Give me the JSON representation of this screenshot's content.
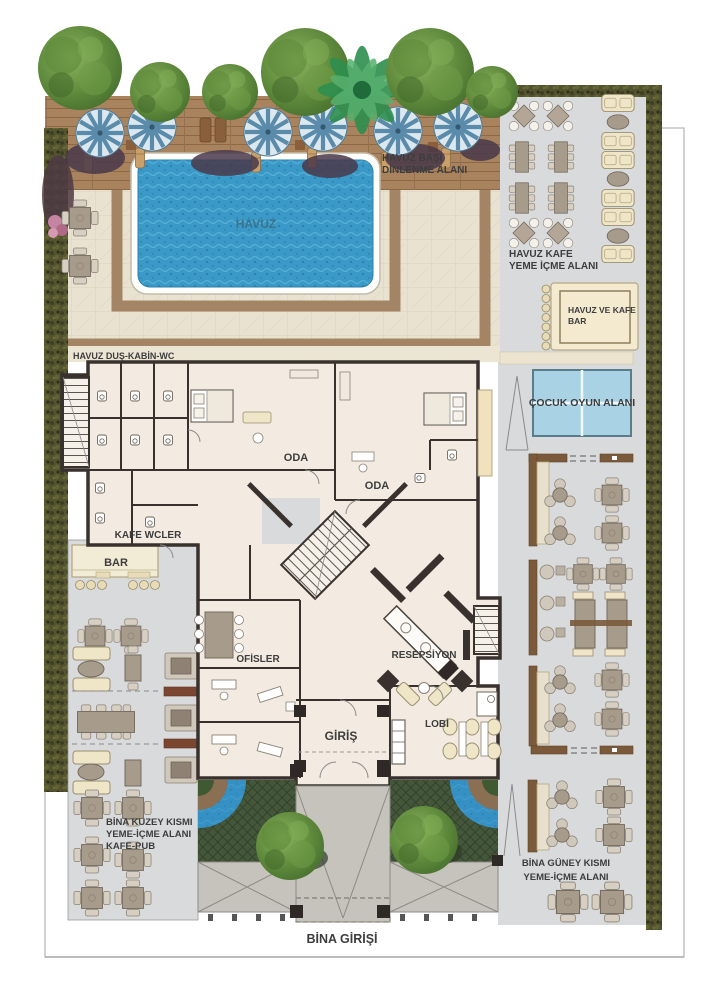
{
  "labels": {
    "pool": "HAVUZ",
    "pool_rest": {
      "l1": "HAVUZ BAŞI",
      "l2": "DİNLENME ALANI"
    },
    "pool_cafe": {
      "l1": "HAVUZ KAFE",
      "l2": "YEME İÇME ALANI"
    },
    "pool_bar": {
      "l1": "HAVUZ VE KAFE",
      "l2": "BAR"
    },
    "kids": "ÇOCUK OYUN ALANI",
    "shower": "HAVUZ DUŞ-KABİN-WC",
    "room_a": "ODA",
    "room_b": "ODA",
    "cafe_wc": "KAFE WCLER",
    "bar": "BAR",
    "offices": "OFİSLER",
    "reception": "RESEPSİYON",
    "entrance": "GİRİŞ",
    "lobby": "LOBİ",
    "north": {
      "l1": "BİNA KUZEY KISMI",
      "l2": "YEME-İÇME ALANI",
      "l3": "KAFE-PUB"
    },
    "south": {
      "l1": "BİNA GÜNEY KISMI",
      "l2": "YEME-İÇME ALANI"
    },
    "building_entrance": "BİNA GİRİŞİ"
  },
  "colors": {
    "pool_water": "#3a99c7",
    "deck_wood": "#a8835d",
    "hedge_green": "#53532f",
    "kids_blue": "#a9d3e5",
    "lattice_green": "#45573a",
    "floor_gray": "#d9dadb",
    "floor_cream": "#f3ebe1",
    "wall_dark": "#38312d",
    "path_brown": "#a38565",
    "fountain_blue": "#2f86c0"
  }
}
